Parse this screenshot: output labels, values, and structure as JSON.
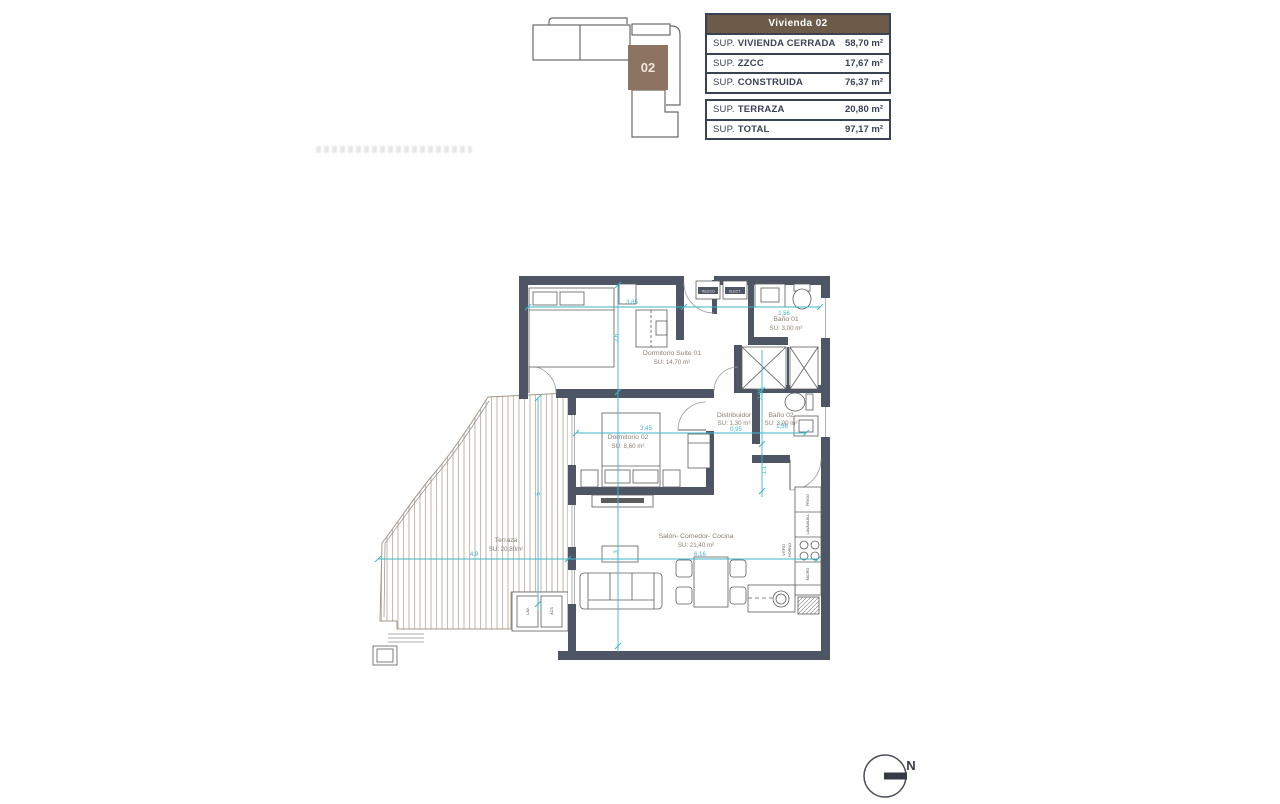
{
  "key_plan": {
    "unit": "02",
    "highlight_color": "#8d7361"
  },
  "area_tables": {
    "header": "Vivienda 02",
    "header_bg": "#6d5b4a",
    "closed": [
      {
        "prefix": "SUP.",
        "name": "VIVIENDA CERRADA",
        "value": "58,70 m²"
      },
      {
        "prefix": "SUP.",
        "name": "ZZCC",
        "value": "17,67 m²"
      },
      {
        "prefix": "SUP.",
        "name": "CONSTRUIDA",
        "value": "76,37 m²"
      }
    ],
    "totals": [
      {
        "prefix": "SUP.",
        "name": "TERRAZA",
        "value": "20,80 m²"
      },
      {
        "prefix": "SUP.",
        "name": "TOTAL",
        "value": "97,17 m²"
      }
    ]
  },
  "floor_plan": {
    "rooms": {
      "suite": {
        "name": "Dormitorio Suite 01",
        "area": "SU: 14,70 m²"
      },
      "bano1": {
        "name": "Baño 01",
        "area": "SU: 3,00 m²"
      },
      "dorm2": {
        "name": "Dormitorio 02",
        "area": "SU: 8,60 m²"
      },
      "distribuidor": {
        "name": "Distribuidor",
        "area": "SU: 1,30 m²"
      },
      "bano2": {
        "name": "Baño 02",
        "area": "SU: 3,00 m²"
      },
      "salon": {
        "name": "Salón- Comedor- Cocina",
        "area": "SU: 21,40 m²"
      },
      "terraza": {
        "name": "Terraza",
        "area": "SU: 20,80m²"
      }
    },
    "dims": [
      "3,85",
      "1,56",
      "2,6",
      "3,45",
      "0,95",
      "1,56",
      "2,65",
      "1,1",
      "4,9",
      "6,16",
      "3",
      "5"
    ],
    "labels": {
      "teleco": "TELECO",
      "elect": "ELECT.",
      "frigo": "FRIGO",
      "lavavajillas": "LAVAVAJILL",
      "vitro": "VITRO",
      "horno": "HORNO",
      "micro": "MICRO",
      "lav": "LAV.",
      "acs": "ACS"
    },
    "dim_color": "#3fb6ca",
    "wall_color": "#4e5565"
  },
  "compass": {
    "north": "N"
  }
}
